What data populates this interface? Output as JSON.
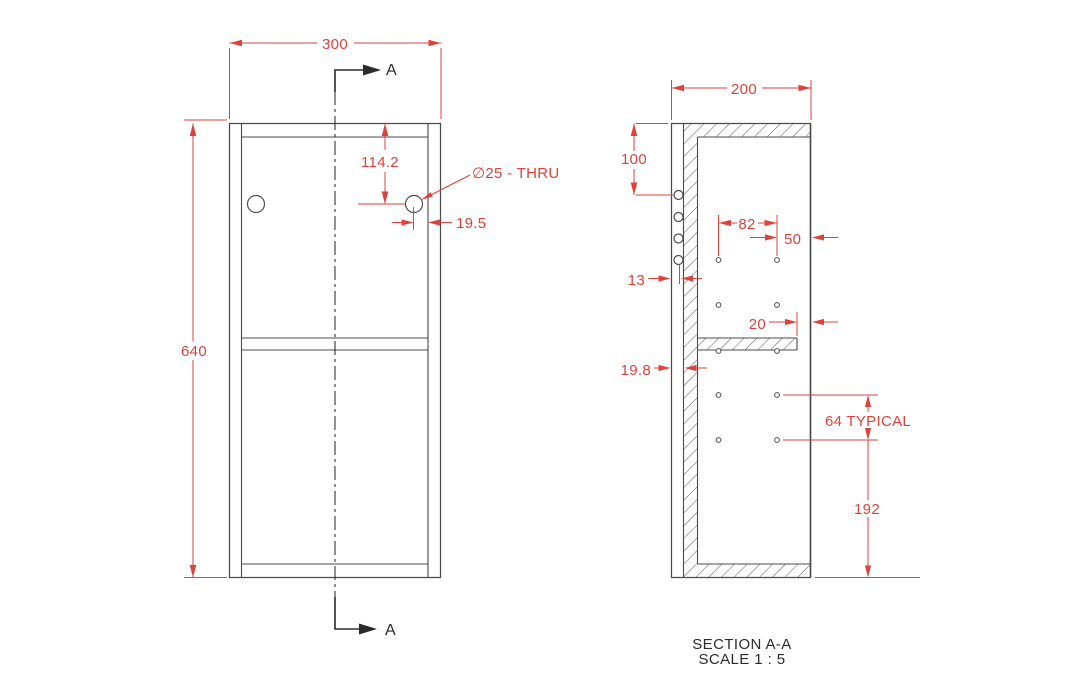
{
  "colors": {
    "dim-red": "#dd423c",
    "line-gray": "#4b4b4b",
    "edge-gray": "#7d7d7d",
    "ink": "#2b2b2b"
  },
  "front_view": {
    "width_dim": "300",
    "height_dim": "640",
    "hole_vertical_dim": "114.2",
    "hole_callout": "∅25 - THRU",
    "hole_edge_dim": "19.5",
    "section_arrow_top_label": "A",
    "section_arrow_bottom_label": "A"
  },
  "section_view": {
    "depth_dim": "200",
    "top_to_first_hole_dim": "100",
    "hole_columns_dim": "82",
    "front_column_dim": "50",
    "back_hole_inset_dim": "13",
    "shelf_setback_dim": "20",
    "back_panel_thickness_dim": "19.8",
    "hole_pitch_dim": "64 TYPICAL",
    "last_hole_to_bottom_dim": "192",
    "title": "SECTION A-A",
    "scale_note": "SCALE 1 : 5"
  }
}
